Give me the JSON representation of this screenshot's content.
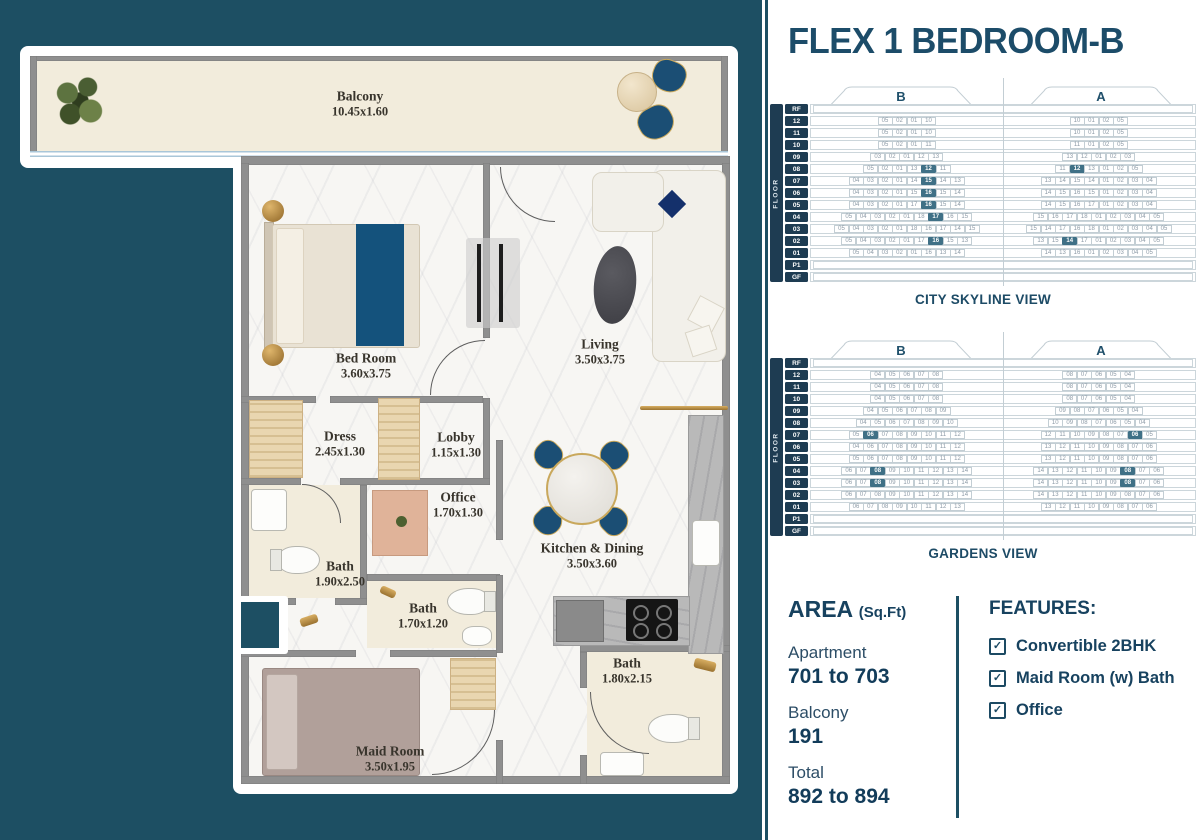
{
  "title": "FLEX 1 BEDROOM-B",
  "colors": {
    "background_teal": "#1d4f63",
    "accent_navy": "#1c4a63",
    "highlight_cell": "#3f7086",
    "bed_blue": "#14527c",
    "gold": "#b98a3f"
  },
  "plan": {
    "balcony": {
      "name": "Balcony",
      "dims": "10.45x1.60"
    },
    "rooms": [
      {
        "name": "Bed Room",
        "dims": "3.60x3.75"
      },
      {
        "name": "Living",
        "dims": "3.50x3.75"
      },
      {
        "name": "Dress",
        "dims": "2.45x1.30"
      },
      {
        "name": "Lobby",
        "dims": "1.15x1.30"
      },
      {
        "name": "Office",
        "dims": "1.70x1.30"
      },
      {
        "name": "Bath",
        "dims": "1.90x2.50"
      },
      {
        "name": "Bath",
        "dims": "1.70x1.20"
      },
      {
        "name": "Kitchen & Dining",
        "dims": "3.50x3.60"
      },
      {
        "name": "Bath",
        "dims": "1.80x2.15"
      },
      {
        "name": "Maid Room",
        "dims": "3.50x1.95"
      }
    ]
  },
  "stacks": [
    {
      "caption": "CITY SKYLINE VIEW",
      "floor_axis_label": "FLOOR",
      "wing_labels": [
        "B",
        "A"
      ],
      "floor_labels": [
        "RF",
        "12",
        "11",
        "10",
        "09",
        "08",
        "07",
        "06",
        "05",
        "04",
        "03",
        "02",
        "01",
        "P1",
        "GF"
      ],
      "rows": {
        "12": {
          "b": [
            "05",
            "02",
            "01",
            "10"
          ],
          "a": [
            "10",
            "01",
            "02",
            "05"
          ]
        },
        "11": {
          "b": [
            "05",
            "02",
            "01",
            "10"
          ],
          "a": [
            "10",
            "01",
            "02",
            "05"
          ]
        },
        "10": {
          "b": [
            "05",
            "02",
            "01",
            "11"
          ],
          "a": [
            "11",
            "01",
            "02",
            "05"
          ]
        },
        "09": {
          "b": [
            "03",
            "02",
            "01",
            "12",
            "13"
          ],
          "a": [
            "13",
            "12",
            "01",
            "02",
            "03"
          ]
        },
        "08": {
          "b": [
            "05",
            "02",
            "01",
            "13",
            "#12",
            "11"
          ],
          "a": [
            "11",
            "#12",
            "13",
            "01",
            "02",
            "05"
          ]
        },
        "07": {
          "b": [
            "04",
            "03",
            "02",
            "01",
            "14",
            "#15",
            "14",
            "13"
          ],
          "a": [
            "13",
            "14",
            "15",
            "14",
            "01",
            "02",
            "03",
            "04"
          ]
        },
        "06": {
          "b": [
            "04",
            "03",
            "02",
            "01",
            "15",
            "#16",
            "15",
            "14"
          ],
          "a": [
            "14",
            "15",
            "16",
            "15",
            "01",
            "02",
            "03",
            "04"
          ]
        },
        "05": {
          "b": [
            "04",
            "03",
            "02",
            "01",
            "17",
            "#16",
            "15",
            "14"
          ],
          "a": [
            "14",
            "15",
            "16",
            "17",
            "01",
            "02",
            "03",
            "04"
          ]
        },
        "04": {
          "b": [
            "05",
            "04",
            "03",
            "02",
            "01",
            "18",
            "#17",
            "16",
            "15"
          ],
          "a": [
            "15",
            "16",
            "17",
            "18",
            "01",
            "02",
            "03",
            "04",
            "05"
          ]
        },
        "03": {
          "b": [
            "05",
            "04",
            "03",
            "02",
            "01",
            "18",
            "16",
            "17",
            "14",
            "15"
          ],
          "a": [
            "15",
            "14",
            "17",
            "16",
            "18",
            "01",
            "02",
            "03",
            "04",
            "05"
          ]
        },
        "02": {
          "b": [
            "05",
            "04",
            "03",
            "02",
            "01",
            "17",
            "#16",
            "15",
            "13"
          ],
          "a": [
            "13",
            "15",
            "#14",
            "17",
            "01",
            "02",
            "03",
            "04",
            "05"
          ]
        },
        "01": {
          "b": [
            "05",
            "04",
            "03",
            "02",
            "01",
            "16",
            "13",
            "14"
          ],
          "a": [
            "14",
            "13",
            "16",
            "01",
            "02",
            "03",
            "04",
            "05"
          ]
        }
      }
    },
    {
      "caption": "GARDENS VIEW",
      "floor_axis_label": "FLOOR",
      "wing_labels": [
        "B",
        "A"
      ],
      "floor_labels": [
        "RF",
        "12",
        "11",
        "10",
        "09",
        "08",
        "07",
        "06",
        "05",
        "04",
        "03",
        "02",
        "01",
        "P1",
        "GF"
      ],
      "rows": {
        "12": {
          "b": [
            "04",
            "05",
            "06",
            "07",
            "08"
          ],
          "a": [
            "08",
            "07",
            "06",
            "05",
            "04"
          ]
        },
        "11": {
          "b": [
            "04",
            "05",
            "06",
            "07",
            "08"
          ],
          "a": [
            "08",
            "07",
            "06",
            "05",
            "04"
          ]
        },
        "10": {
          "b": [
            "04",
            "05",
            "06",
            "07",
            "08"
          ],
          "a": [
            "08",
            "07",
            "06",
            "05",
            "04"
          ]
        },
        "09": {
          "b": [
            "04",
            "05",
            "06",
            "07",
            "08",
            "09"
          ],
          "a": [
            "09",
            "08",
            "07",
            "06",
            "05",
            "04"
          ]
        },
        "08": {
          "b": [
            "04",
            "05",
            "06",
            "07",
            "08",
            "09",
            "10"
          ],
          "a": [
            "10",
            "09",
            "08",
            "07",
            "06",
            "05",
            "04"
          ]
        },
        "07": {
          "b": [
            "05",
            "#06",
            "07",
            "08",
            "09",
            "10",
            "11",
            "12"
          ],
          "a": [
            "12",
            "11",
            "10",
            "09",
            "08",
            "07",
            "#06",
            "05"
          ]
        },
        "06": {
          "b": [
            "04",
            "06",
            "07",
            "08",
            "09",
            "10",
            "11",
            "12"
          ],
          "a": [
            "13",
            "12",
            "11",
            "10",
            "09",
            "08",
            "07",
            "06"
          ]
        },
        "05": {
          "b": [
            "05",
            "06",
            "07",
            "08",
            "09",
            "10",
            "11",
            "12"
          ],
          "a": [
            "13",
            "12",
            "11",
            "10",
            "09",
            "08",
            "07",
            "06"
          ]
        },
        "04": {
          "b": [
            "06",
            "07",
            "#08",
            "09",
            "10",
            "11",
            "12",
            "13",
            "14"
          ],
          "a": [
            "14",
            "13",
            "12",
            "11",
            "10",
            "09",
            "#08",
            "07",
            "06"
          ]
        },
        "03": {
          "b": [
            "06",
            "07",
            "#08",
            "09",
            "10",
            "11",
            "12",
            "13",
            "14"
          ],
          "a": [
            "14",
            "13",
            "12",
            "11",
            "10",
            "09",
            "#08",
            "07",
            "06"
          ]
        },
        "02": {
          "b": [
            "06",
            "07",
            "08",
            "09",
            "10",
            "11",
            "12",
            "13",
            "14"
          ],
          "a": [
            "14",
            "13",
            "12",
            "11",
            "10",
            "09",
            "08",
            "07",
            "06"
          ]
        },
        "01": {
          "b": [
            "06",
            "07",
            "08",
            "09",
            "10",
            "11",
            "12",
            "13"
          ],
          "a": [
            "13",
            "12",
            "11",
            "10",
            "09",
            "08",
            "07",
            "06"
          ]
        }
      }
    }
  ],
  "area": {
    "heading": "AREA",
    "heading_unit": "(Sq.Ft)",
    "items": [
      {
        "label": "Apartment",
        "value": "701 to 703"
      },
      {
        "label": "Balcony",
        "value": "191"
      },
      {
        "label": "Total",
        "value": "892 to 894"
      }
    ]
  },
  "features": {
    "heading": "FEATURES:",
    "items": [
      "Convertible 2BHK",
      "Maid Room (w) Bath",
      "Office"
    ]
  }
}
